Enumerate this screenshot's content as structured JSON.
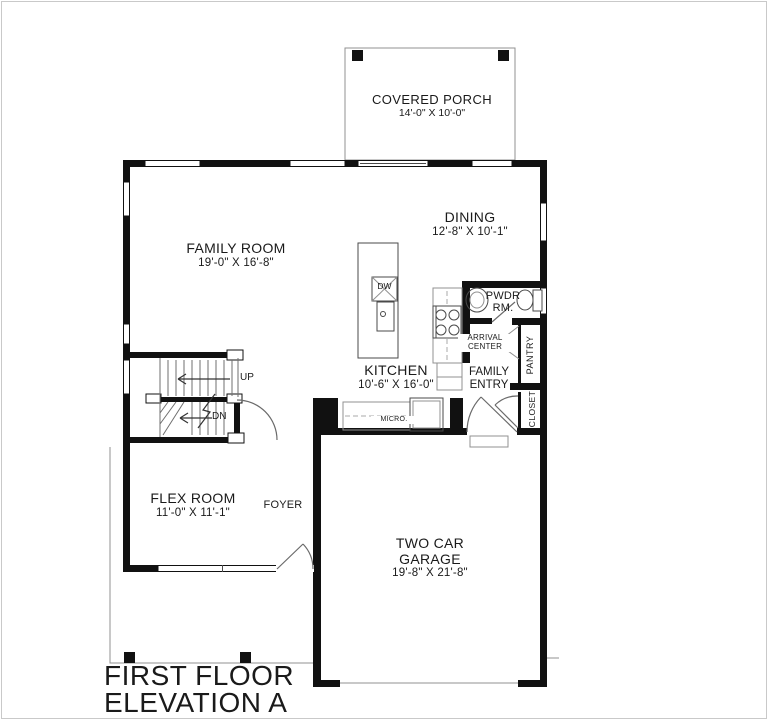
{
  "title": {
    "line1": "FIRST FLOOR",
    "line2": "ELEVATION A"
  },
  "rooms": {
    "covered_porch": {
      "name": "COVERED PORCH",
      "dims": "14'-0\" X 10'-0\""
    },
    "family_room": {
      "name": "FAMILY ROOM",
      "dims": "19'-0\" X 16'-8\""
    },
    "dining": {
      "name": "DINING",
      "dims": "12'-8\" X 10'-1\""
    },
    "kitchen": {
      "name": "KITCHEN",
      "dims": "10'-6\" X 16'-0\""
    },
    "flex_room": {
      "name": "FLEX ROOM",
      "dims": "11'-0\" X 11'-1\""
    },
    "foyer": {
      "name": "FOYER"
    },
    "garage": {
      "line1": "TWO CAR",
      "line2": "GARAGE",
      "dims": "19'-8\" X 21'-8\""
    },
    "powder": {
      "line1": "PWDR",
      "line2": "RM."
    },
    "arrival": {
      "line1": "ARRIVAL",
      "line2": "CENTER"
    },
    "family_entry": {
      "line1": "FAMILY",
      "line2": "ENTRY"
    },
    "pantry": {
      "name": "PANTRY"
    },
    "closet": {
      "name": "CLOSET"
    }
  },
  "stairs": {
    "up": "UP",
    "down": "DN"
  },
  "appliances": {
    "dishwasher": "DW",
    "microwave": "MICRO."
  },
  "colors": {
    "wall": "#111111",
    "thin_line": "#909090",
    "text": "#1a1a1a"
  }
}
